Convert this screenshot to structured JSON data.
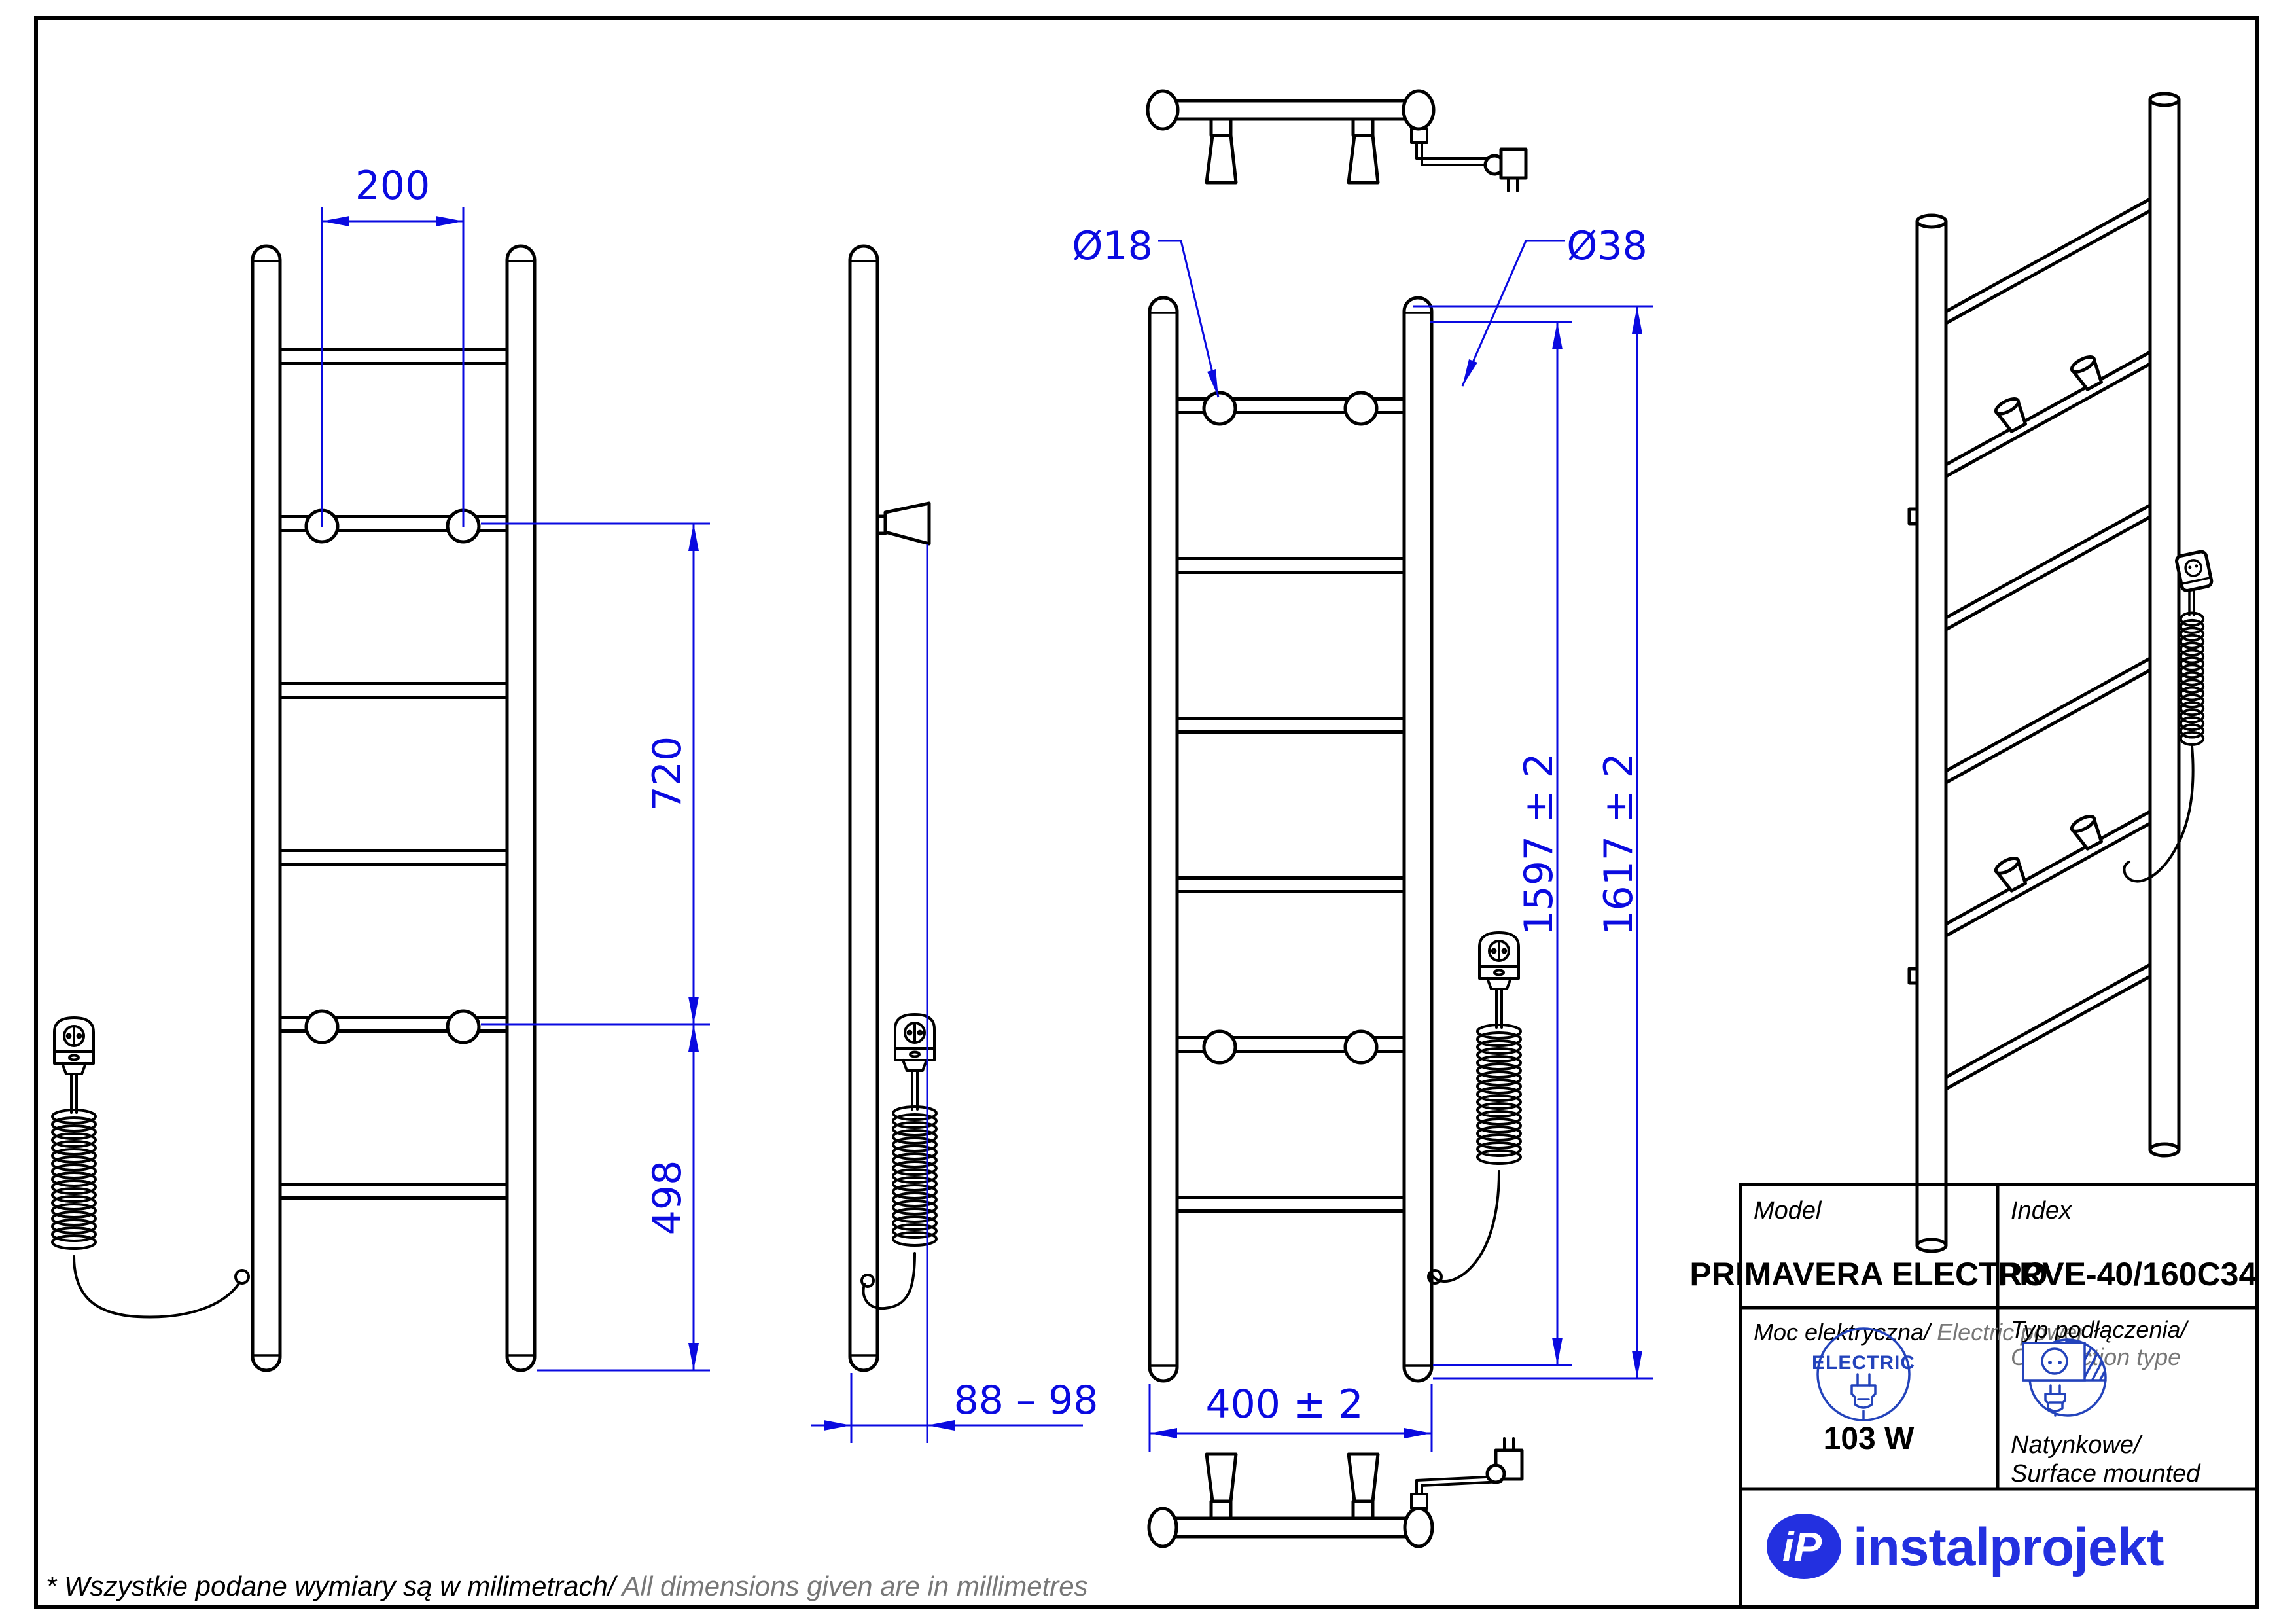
{
  "colors": {
    "dim": "#0a0ae0",
    "icon": "#2343bb",
    "logo": "#2330e0",
    "gray": "#777777"
  },
  "dimensions": {
    "hook_spacing": "200",
    "hook_span": "720",
    "hook_to_bottom": "498",
    "wall_distance": "88 – 98",
    "width": "400 ± 2",
    "mount_height": "1597 ± 2",
    "total_height": "1617 ± 2",
    "rung_diameter": "Ø18",
    "collector_diameter": "Ø38"
  },
  "title_block": {
    "model_label": "Model",
    "model_value": "PRIMAVERA ELECTRO",
    "index_label": "Index",
    "index_value": "PRVE-40/160C34",
    "power_label_pl": "Moc elektryczna/",
    "power_label_en": " Electric power",
    "power_value": "103 W",
    "electric_badge": "ELECTRIC",
    "connection_label_pl": "Typ podłączenia/",
    "connection_label_en": "Connection type",
    "connection_value_pl": "Natynkowe/",
    "connection_value_en": "Surface mounted"
  },
  "logo": {
    "monogram": "iP",
    "wordmark": "instalprojekt"
  },
  "footer": {
    "note_pl": "* Wszystkie podane wymiary są w milimetrach/",
    "note_en": " All dimensions given are in millimetres"
  }
}
